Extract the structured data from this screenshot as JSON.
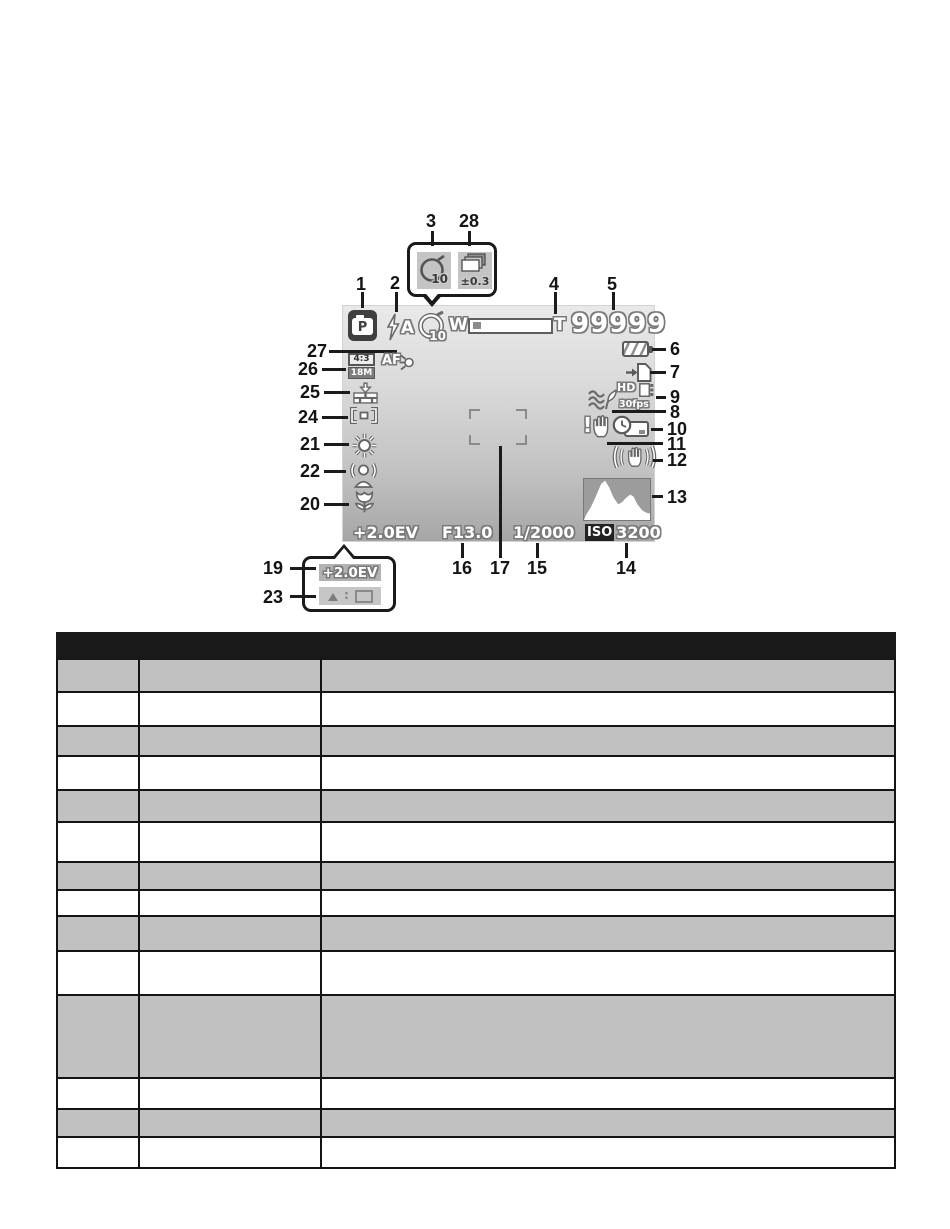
{
  "screen": {
    "mode": "P",
    "flash_label": "A",
    "selftimer_value": "10",
    "zoom_wide": "W",
    "zoom_tele": "T",
    "shots_remaining": "99999",
    "resolution_ratio": "4:3",
    "resolution_mp": "18M",
    "af_label": "AF",
    "movie_hd": "HD",
    "movie_fps": "30fps",
    "shake_mark": "!",
    "exposure": "+2.0EV",
    "aperture": "F13.0",
    "shutter": "1/2000",
    "iso_prefix": "ISO",
    "iso_value": "3200"
  },
  "inset_top": {
    "selftimer_value": "10",
    "bracket_value": "±0.3"
  },
  "inset_bottom": {
    "exposure": "+2.0EV",
    "hint_separator": ":"
  },
  "callouts": {
    "c1": "1",
    "c2": "2",
    "c3": "3",
    "c4": "4",
    "c5": "5",
    "c6": "6",
    "c7": "7",
    "c8": "8",
    "c9": "9",
    "c10": "10",
    "c11": "11",
    "c12": "12",
    "c13": "13",
    "c14": "14",
    "c15": "15",
    "c16": "16",
    "c17": "17",
    "c19": "19",
    "c20": "20",
    "c21": "21",
    "c22": "22",
    "c23": "23",
    "c24": "24",
    "c25": "25",
    "c26": "26",
    "c27": "27",
    "c28": "28"
  },
  "table": {
    "header": [
      "",
      "",
      ""
    ],
    "rows": [
      [
        "",
        "",
        ""
      ],
      [
        "",
        "",
        ""
      ],
      [
        "",
        "",
        ""
      ],
      [
        "",
        "",
        ""
      ],
      [
        "",
        "",
        ""
      ],
      [
        "",
        "",
        ""
      ],
      [
        "",
        "",
        ""
      ],
      [
        "",
        "",
        ""
      ],
      [
        "",
        "",
        ""
      ],
      [
        "",
        "",
        ""
      ],
      [
        "",
        "",
        ""
      ],
      [
        "",
        "",
        ""
      ],
      [
        "",
        "",
        ""
      ],
      [
        "",
        "",
        ""
      ]
    ]
  },
  "colors": {
    "table_header_bg": "#191919",
    "table_alt_row_bg": "#c1c1c1",
    "screen_icon_outline": "#6a6a6a",
    "callout_ink": "#1b1b1b"
  }
}
